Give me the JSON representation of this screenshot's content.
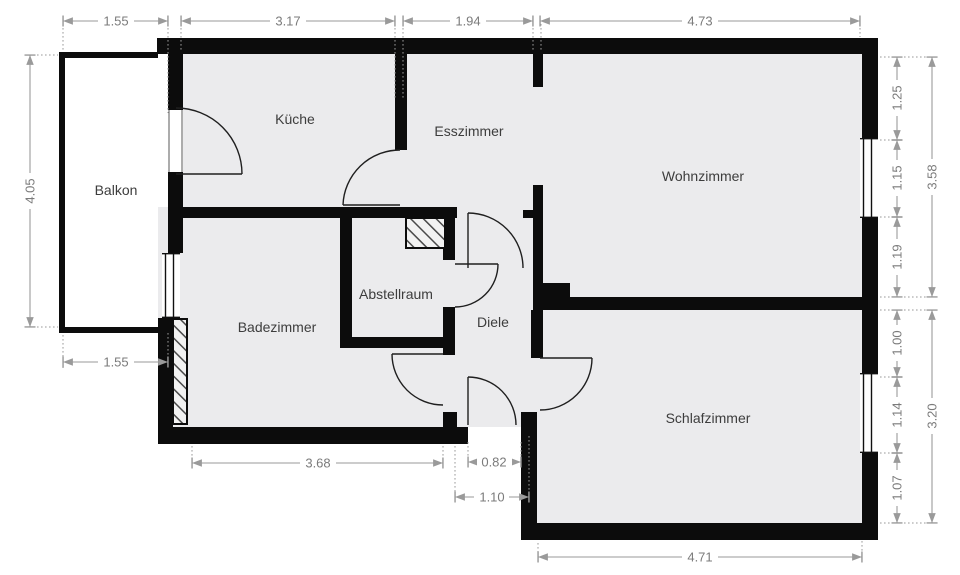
{
  "plan": {
    "title": "Wohnung Grundriss",
    "rooms": {
      "balkon": "Balkon",
      "kueche": "Küche",
      "esszimmer": "Esszimmer",
      "wohnzimmer": "Wohnzimmer",
      "badezimmer": "Badezimmer",
      "abstellraum": "Abstellraum",
      "diele": "Diele",
      "schlafzimmer": "Schlafzimmer"
    },
    "dims": {
      "top": [
        "1.55",
        "3.17",
        "1.94",
        "4.73"
      ],
      "left_height": "4.05",
      "balcony_width_bottom": "1.55",
      "bottom": [
        "3.68",
        "0.82",
        "1.10",
        "4.71"
      ],
      "right_upper": [
        "1.25",
        "1.15",
        "1.19"
      ],
      "right_upper_total": "3.58",
      "right_lower": [
        "1.00",
        "1.14",
        "1.07"
      ],
      "right_lower_total": "3.20"
    },
    "colors": {
      "wall": "#0c0c0c",
      "floor": "#ebebed",
      "background": "#ffffff",
      "dimension_line": "#9a9a9a",
      "dimension_text": "#7b7b7b",
      "room_label_text": "#3d3d3d"
    }
  }
}
